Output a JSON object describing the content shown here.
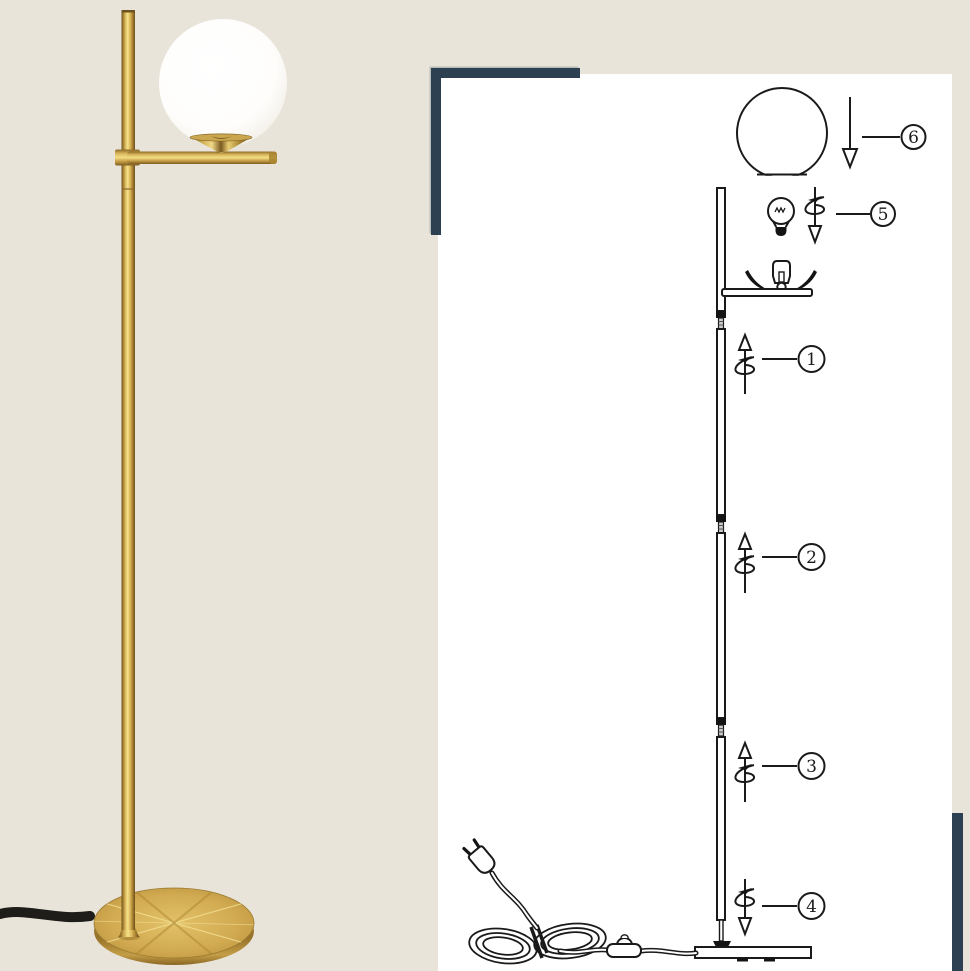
{
  "colors": {
    "background": "#e8e4da",
    "panel": "#ffffff",
    "accent_navy": "#2c4052",
    "line": "#1a1a1a",
    "gold_light": "#f4e28a",
    "gold_mid": "#d8b75e",
    "gold_dark": "#6e521e",
    "cord_black": "#1f1d1a"
  },
  "photo": {
    "description": "brass floor lamp with white glass globe on cream background"
  },
  "diagram": {
    "steps": [
      {
        "label": "1",
        "icon": "screw-up-icon"
      },
      {
        "label": "2",
        "icon": "screw-up-icon"
      },
      {
        "label": "3",
        "icon": "screw-up-icon"
      },
      {
        "label": "4",
        "icon": "screw-down-icon"
      },
      {
        "label": "5",
        "icon": "screw-down-icon"
      },
      {
        "label": "6",
        "icon": "arrow-down-icon"
      }
    ]
  }
}
